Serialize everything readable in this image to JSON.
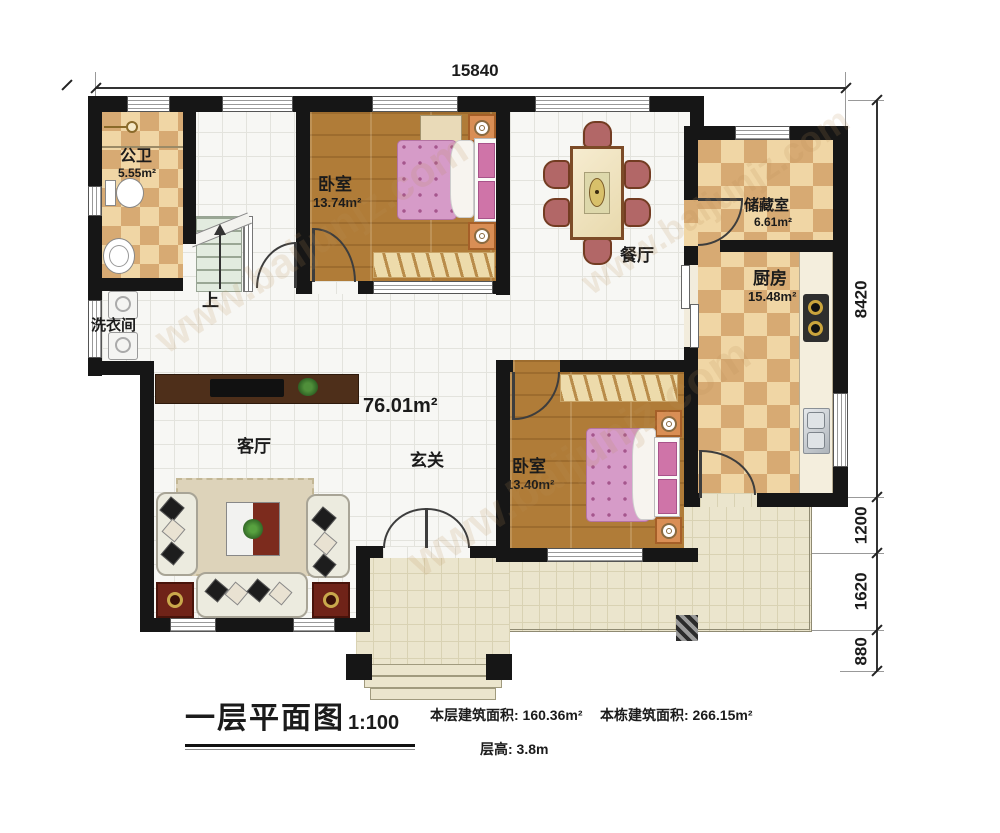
{
  "watermark": {
    "text": "www.baijunjz.com"
  },
  "dimensions": {
    "top": "15840",
    "right": [
      {
        "label": "8420"
      },
      {
        "label": "1200"
      },
      {
        "label": "1620"
      },
      {
        "label": "880"
      }
    ]
  },
  "rooms": {
    "bathroom": {
      "name": "公卫",
      "area": "5.55m²"
    },
    "bedroom1": {
      "name": "卧室",
      "area": "13.74m²"
    },
    "dining": {
      "name": "餐厅"
    },
    "storage": {
      "name": "储藏室",
      "area": "6.61m²"
    },
    "kitchen": {
      "name": "厨房",
      "area": "15.48m²"
    },
    "laundry": {
      "name": "洗衣间"
    },
    "living": {
      "name": "客厅"
    },
    "foyer": {
      "name": "玄关"
    },
    "bedroom2": {
      "name": "卧室",
      "area": "13.40m²"
    },
    "open_area": {
      "area": "76.01m²"
    },
    "stairs": {
      "direction": "上"
    }
  },
  "title_block": {
    "title": "一层平面图",
    "scale": "1:100",
    "floor_area": "本层建筑面积: 160.36m²",
    "total_area": "本栋建筑面积: 266.15m²",
    "floor_height": "层高: 3.8m"
  }
}
